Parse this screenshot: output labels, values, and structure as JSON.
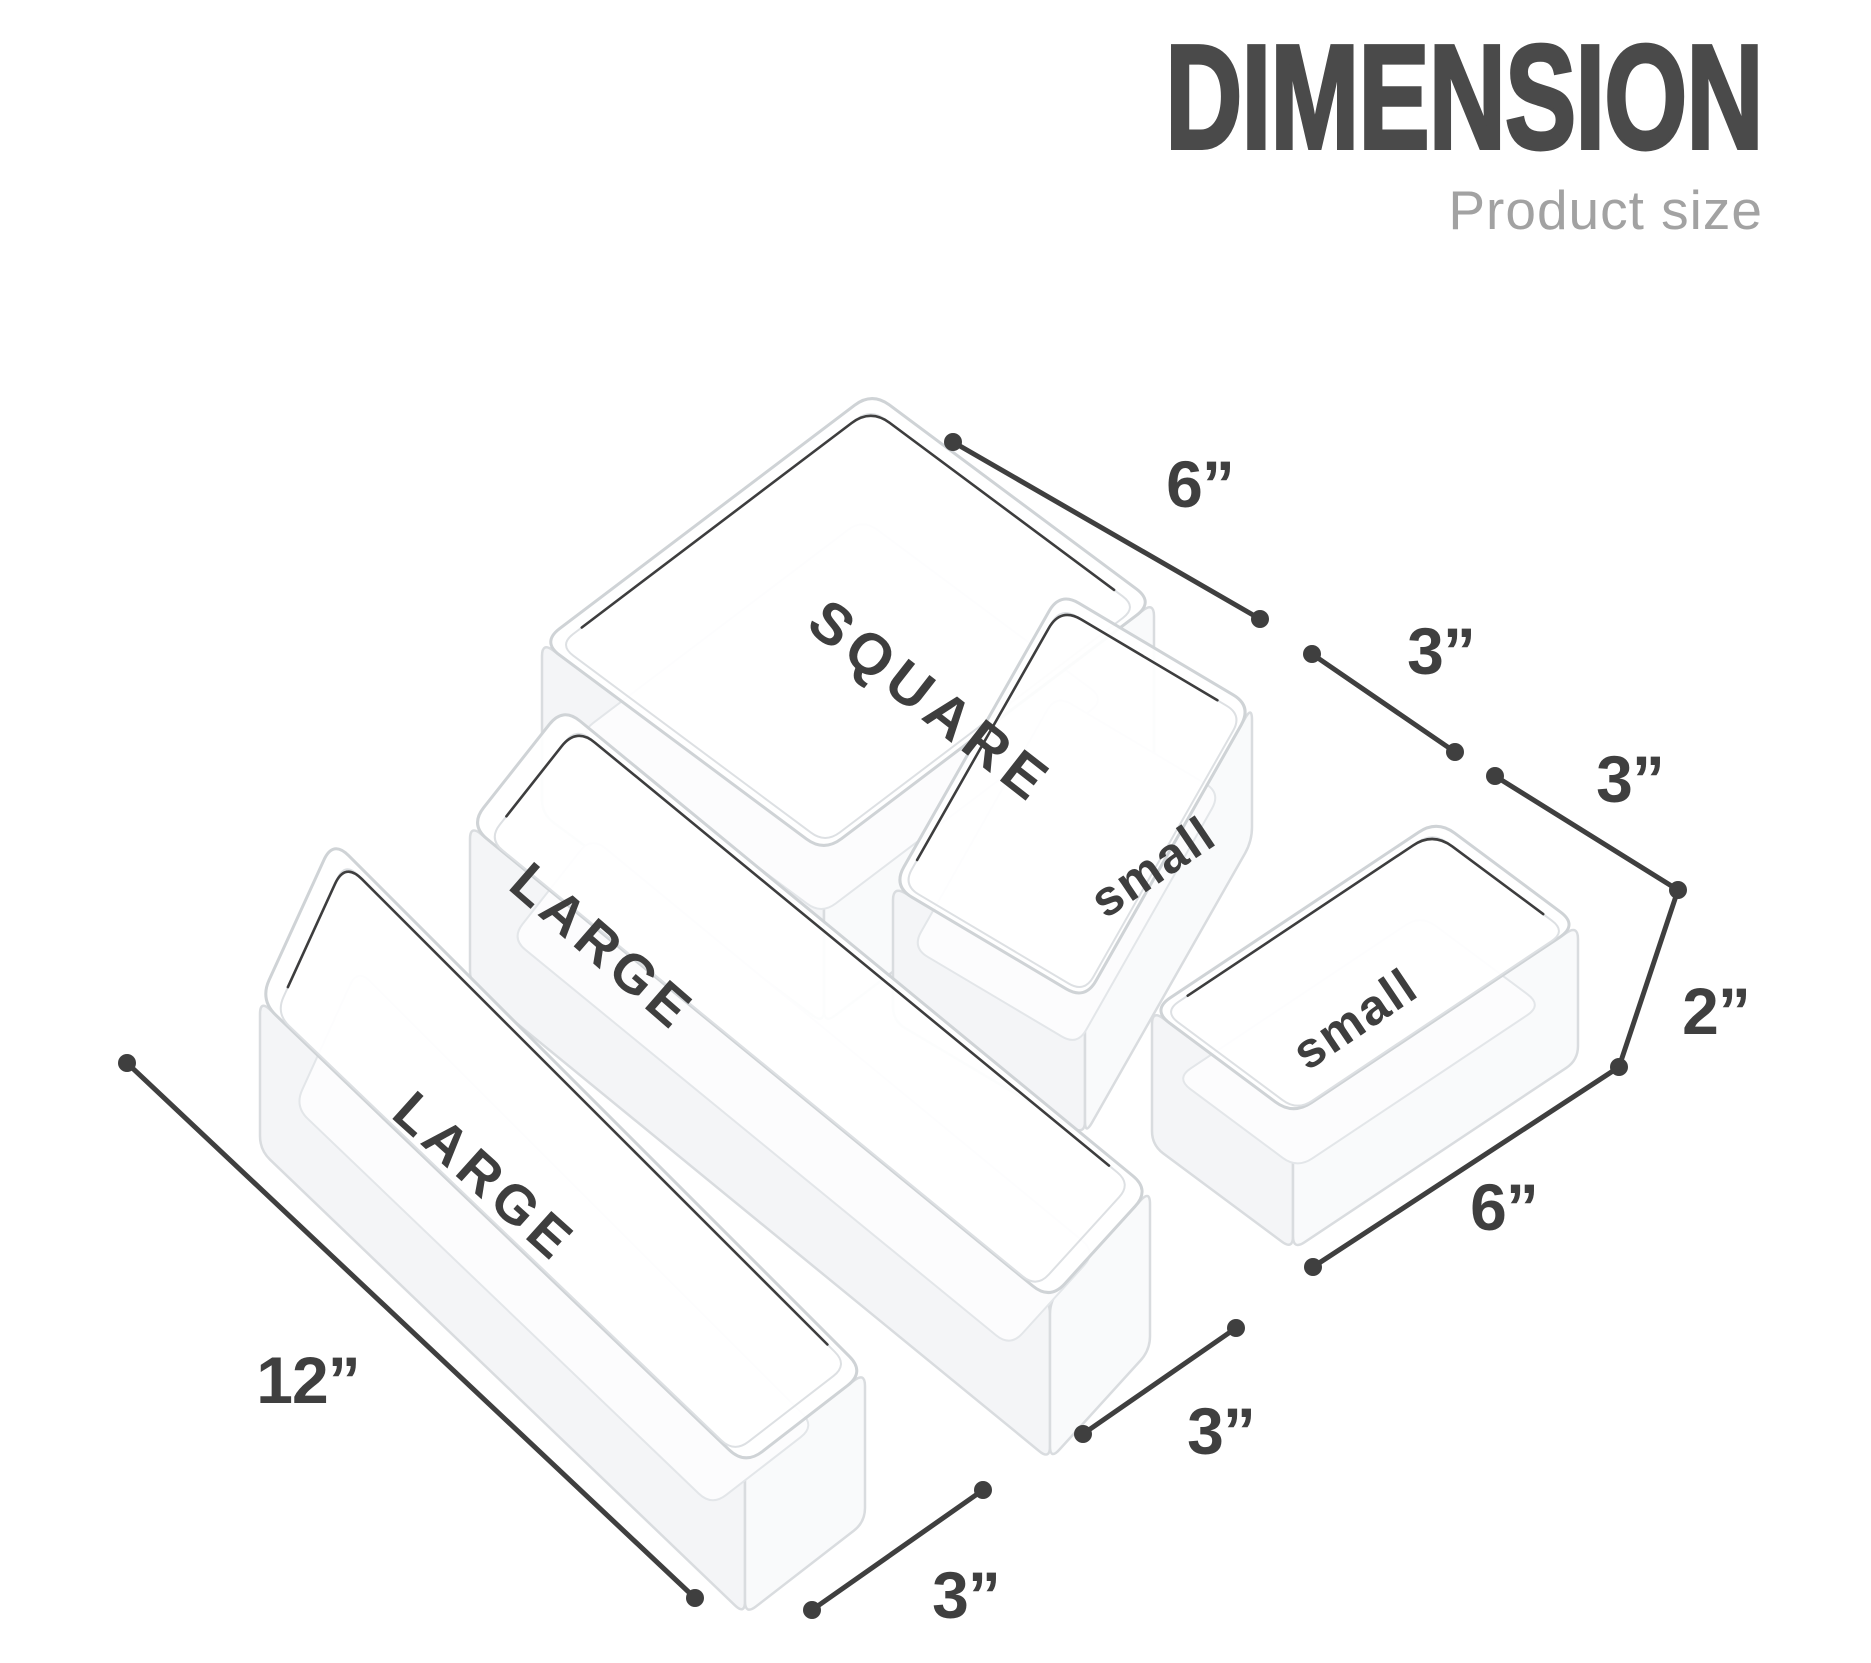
{
  "header": {
    "title": "DIMENSION",
    "subtitle": "Product size"
  },
  "trays": {
    "square": {
      "label": "SQUARE"
    },
    "small_1": {
      "label": "small"
    },
    "small_2": {
      "label": "small"
    },
    "large_1": {
      "label": "LARGE"
    },
    "large_2": {
      "label": "LARGE"
    }
  },
  "dimensions": {
    "square_width": "6”",
    "small_1_width": "3”",
    "small_2_width": "3”",
    "height": "2”",
    "small_2_length": "6”",
    "large_2_width": "3”",
    "large_1_length": "12”",
    "large_1_width": "3”"
  },
  "colors": {
    "title": "#4a4a4a",
    "subtitle": "#a2a2a2",
    "dimension_accent": "#3f3f3f",
    "tray_label": "#3e3e3e",
    "tray_outline": "#cfd3d6"
  }
}
